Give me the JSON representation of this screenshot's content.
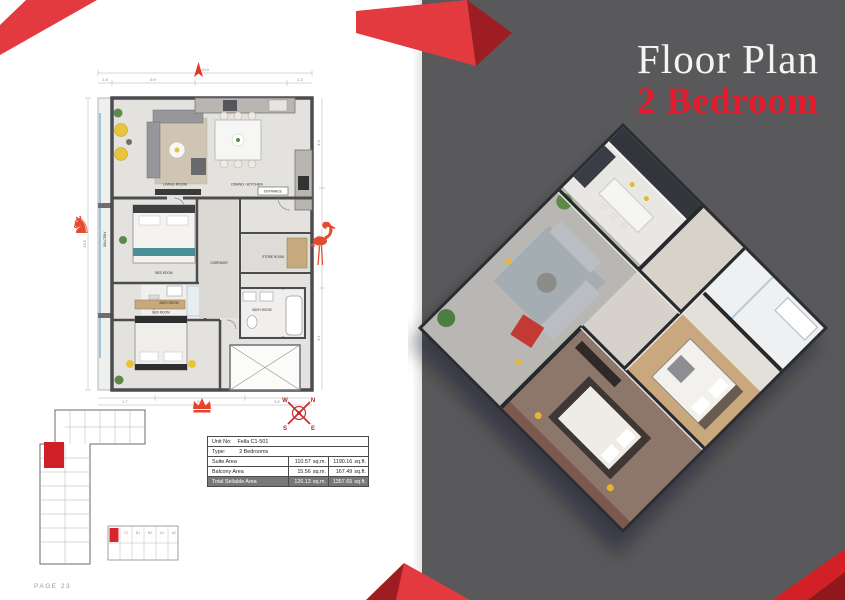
{
  "right_page": {
    "title": "Floor Plan",
    "subtitle": "2 Bedroom",
    "page_number": "24"
  },
  "left_page": {
    "page_label": "PAGE 23",
    "plan": {
      "labels": [
        "LIVING ROOM",
        "DINING / KITCHEN",
        "ENTRANCE",
        "BALCONY",
        "BED ROOM",
        "CORRIDOR",
        "STORE ROOM",
        "BATH ROOM",
        "BED ROOM",
        "BATH ROOM"
      ],
      "dims": {
        "top": [
          "1.8",
          "6.9",
          "1.3"
        ],
        "top_total": "10.0",
        "left_total": "13.9",
        "right": [
          "4.3",
          "6.5",
          "3.1"
        ],
        "bottom": [
          "1.7",
          "5.1",
          "3.2"
        ],
        "bottom_total": "10.0"
      }
    },
    "compass": {
      "n": "N",
      "e": "E",
      "s": "S",
      "w": "W"
    },
    "key_plan_blocks": [
      "C2",
      "B1",
      "B2",
      "A1",
      "A2"
    ],
    "table": {
      "unit_no_label": "Unit No:",
      "unit_no": "Fella C1-501",
      "type_label": "Type:",
      "type": "2 Bedrooms",
      "rows": [
        {
          "label": "Suite Area",
          "sqm": "110.57",
          "sqm_unit": "sq.m.",
          "sqft": "1190.16",
          "sqft_unit": "sq.ft."
        },
        {
          "label": "Balcony Area",
          "sqm": "15.56",
          "sqm_unit": "sq.m.",
          "sqft": "167.49",
          "sqft_unit": "sq.ft."
        },
        {
          "label": "Total Sellable Area",
          "sqm": "126.13",
          "sqm_unit": "sq.m.",
          "sqft": "1357.65",
          "sqft_unit": "sq.ft."
        }
      ]
    }
  },
  "colors": {
    "accent_red": "#e31b2c",
    "ribbon_red": "#e23a3e",
    "ribbon_dark_red": "#9e1d22",
    "icon_red": "#e8432b",
    "page_gray": "#59595b",
    "wall_gray": "#4c4c4e",
    "total_row_bg": "#77787a",
    "accent_yellow": "#e9c43a"
  }
}
